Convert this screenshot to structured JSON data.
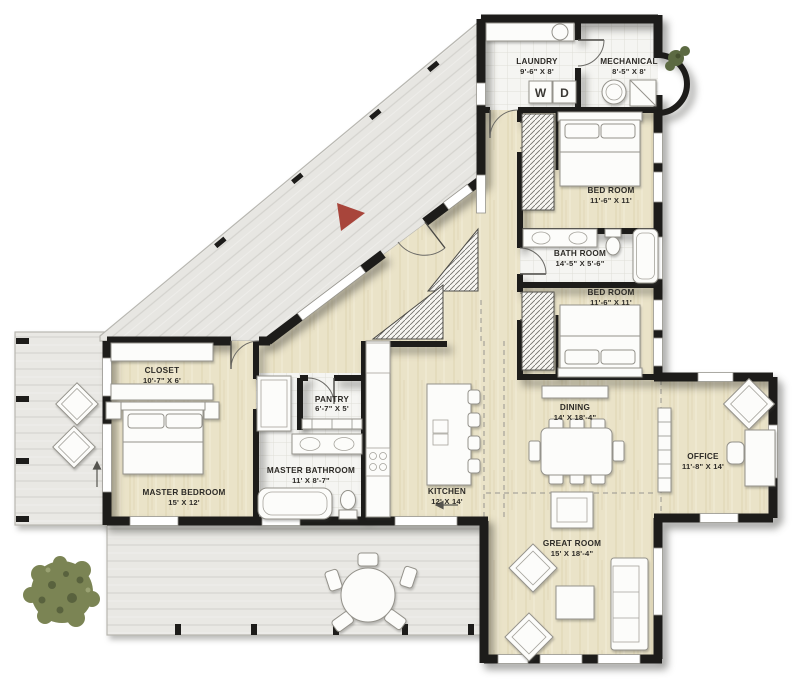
{
  "plan": {
    "rooms": {
      "laundry": {
        "name": "LAUNDRY",
        "dims": "9'-6\" X 8'"
      },
      "mechanical": {
        "name": "MECHANICAL",
        "dims": "8'-5\" X 8'"
      },
      "bedroom_top": {
        "name": "BED ROOM",
        "dims": "11'-6\" X 11'"
      },
      "bathroom": {
        "name": "BATH ROOM",
        "dims": "14'-5\" X 5'-6\""
      },
      "bedroom_bottom": {
        "name": "BED ROOM",
        "dims": "11'-6\" X 11'"
      },
      "closet": {
        "name": "CLOSET",
        "dims": "10'-7\" X 6'"
      },
      "pantry": {
        "name": "PANTRY",
        "dims": "6'-7\" X 5'"
      },
      "master_bathroom": {
        "name": "MASTER BATHROOM",
        "dims": "11' X 8'-7\""
      },
      "master_bedroom": {
        "name": "MASTER BEDROOM",
        "dims": "15' X 12'"
      },
      "kitchen": {
        "name": "KITCHEN",
        "dims": "12' X 14'"
      },
      "dining": {
        "name": "DINING",
        "dims": "14' X 18'-4\""
      },
      "office": {
        "name": "OFFICE",
        "dims": "11'-8\" X 14'"
      },
      "great_room": {
        "name": "GREAT ROOM",
        "dims": "15' X 18'-4\""
      }
    },
    "appliances": {
      "washer": "W",
      "dryer": "D"
    },
    "colors": {
      "wall": "#1d1c1a",
      "wood_floor": "#eae3c8",
      "deck": "#e9e8e4",
      "tile": "#f5f5f2",
      "entry_arrow": "#a8453b",
      "foliage": "#7b8454"
    }
  }
}
